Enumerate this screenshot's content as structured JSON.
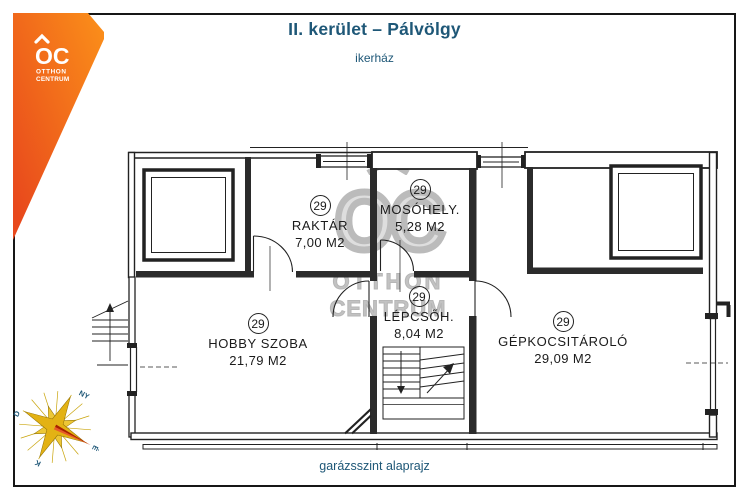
{
  "header": {
    "title": "II. kerület – Pálvölgy",
    "subtitle": "ikerház"
  },
  "footer": {
    "caption": "garázsszint alaprajz"
  },
  "logo": {
    "monogram": "OC",
    "line1": "OTTHON",
    "line2": "CENTRUM"
  },
  "watermark": {
    "monogram": "OC",
    "line1": "OTTHON",
    "line2": "CENTRUM"
  },
  "compass": {
    "north": "É",
    "south": "D",
    "east": "K",
    "west": "NY"
  },
  "rooms": [
    {
      "number": "29",
      "name": "RAKTÁR",
      "area": "7,00 M2"
    },
    {
      "number": "29",
      "name": "MOSÓHELY.",
      "area": "5,28 M2"
    },
    {
      "number": "29",
      "name": "LÉPCSŐH.",
      "area": "8,04 M2"
    },
    {
      "number": "29",
      "name": "HOBBY SZOBA",
      "area": "21,79 M2"
    },
    {
      "number": "29",
      "name": "GÉPKOCSITÁROLÓ",
      "area": "29,09 M2"
    }
  ],
  "colors": {
    "title_teal": "#1E5777",
    "logo_orange_top": "#FA8C1A",
    "logo_orange_bottom": "#E8481C",
    "plan_line": "#222222",
    "watermark_gray": "#ABABAB",
    "compass_gold": "#E3B214",
    "compass_red": "#C62A00"
  }
}
